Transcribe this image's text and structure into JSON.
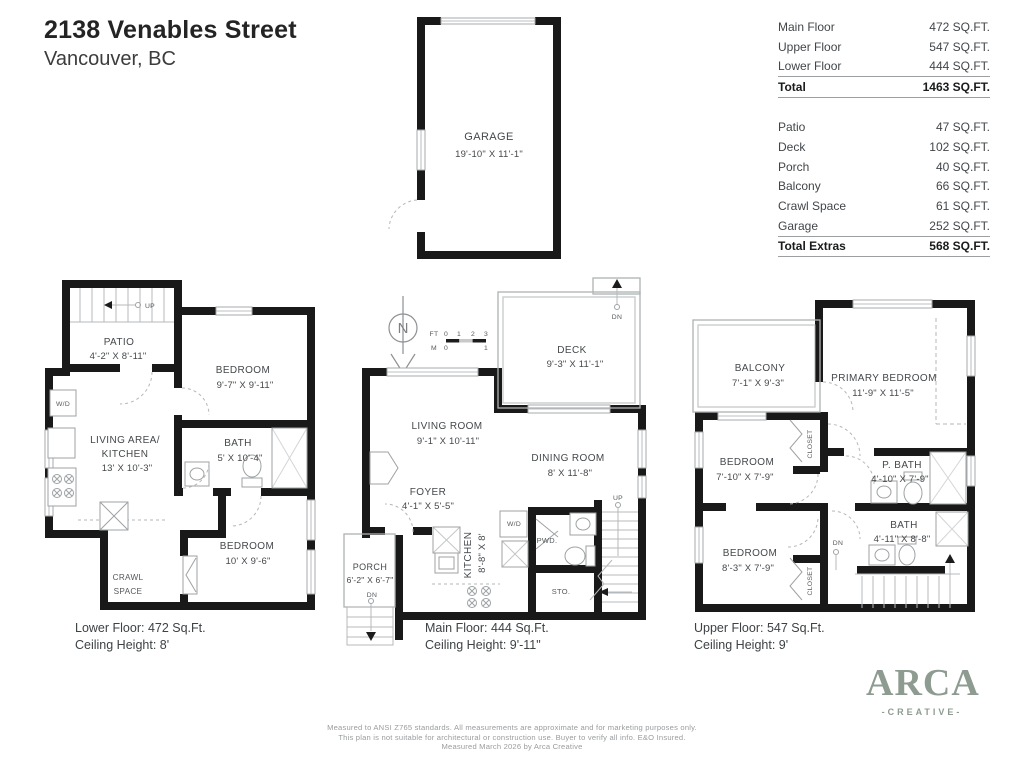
{
  "title": {
    "address": "2138 Venables Street",
    "city": "Vancouver, BC"
  },
  "area_table": {
    "floors": [
      {
        "label": "Main Floor",
        "value": "472 SQ.FT."
      },
      {
        "label": "Upper Floor",
        "value": "547 SQ.FT."
      },
      {
        "label": "Lower Floor",
        "value": "444 SQ.FT."
      }
    ],
    "total": {
      "label": "Total",
      "value": "1463 SQ.FT."
    },
    "extras": [
      {
        "label": "Patio",
        "value": "47 SQ.FT."
      },
      {
        "label": "Deck",
        "value": "102 SQ.FT."
      },
      {
        "label": "Porch",
        "value": "40 SQ.FT."
      },
      {
        "label": "Balcony",
        "value": "66 SQ.FT."
      },
      {
        "label": "Crawl Space",
        "value": "61 SQ.FT."
      },
      {
        "label": "Garage",
        "value": "252 SQ.FT."
      }
    ],
    "total_extras": {
      "label": "Total Extras",
      "value": "568 SQ.FT."
    }
  },
  "garage": {
    "label": "GARAGE",
    "dims": "19'-10\" X 11'-1\""
  },
  "compass": {
    "letter": "N"
  },
  "scale_bar": {
    "ft": "FT",
    "m": "M",
    "ft0": "0",
    "ft1": "1",
    "ft2": "2",
    "ft3": "3",
    "m0": "0",
    "m1": "1"
  },
  "lower_floor": {
    "patio": {
      "label": "PATIO",
      "dims": "4'-2\" X 8'-11\""
    },
    "bedroom_top": {
      "label": "BEDROOM",
      "dims": "9'-7\" X 9'-11\""
    },
    "living": {
      "label_line1": "LIVING AREA/",
      "label_line2": "KITCHEN",
      "dims": "13' X 10'-3\""
    },
    "bath": {
      "label": "BATH",
      "dims": "5' X 10'-4\""
    },
    "bedroom_bottom": {
      "label": "BEDROOM",
      "dims": "10' X 9'-6\""
    },
    "crawl_line1": "CRAWL",
    "crawl_line2": "SPACE",
    "wd": "W/D",
    "up": "UP",
    "caption_line1": "Lower Floor: 472 Sq.Ft.",
    "caption_line2": "Ceiling Height: 8'"
  },
  "main_floor": {
    "deck": {
      "label": "DECK",
      "dims": "9'-3\" X 11'-1\""
    },
    "living": {
      "label": "LIVING ROOM",
      "dims": "9'-1\" X 10'-11\""
    },
    "dining": {
      "label": "DINING ROOM",
      "dims": "8' X 11'-8\""
    },
    "foyer": {
      "label": "FOYER",
      "dims": "4'-1\" X 5'-5\""
    },
    "porch": {
      "label": "PORCH",
      "dims": "6'-2\" X 6'-7\""
    },
    "kitchen": {
      "label": "KITCHEN",
      "dims": "8'-8\" X 8'"
    },
    "wd": "W/D",
    "pwd": "PWD.",
    "sto": "STO.",
    "up": "UP",
    "dn_porch": "DN",
    "dn_deck": "DN",
    "caption_line1": "Main Floor: 444 Sq.Ft.",
    "caption_line2": "Ceiling Height: 9'-11\""
  },
  "upper_floor": {
    "balcony": {
      "label": "BALCONY",
      "dims": "7'-1\" X 9'-3\""
    },
    "primary": {
      "label": "PRIMARY BEDROOM",
      "dims": "11'-9\" X 11'-5\""
    },
    "bedroom_mid": {
      "label": "BEDROOM",
      "dims": "7'-10\" X 7'-9\""
    },
    "bedroom_bottom": {
      "label": "BEDROOM",
      "dims": "8'-3\" X 7'-9\""
    },
    "pbath": {
      "label": "P. BATH",
      "dims": "4'-10\" X 7'-9\""
    },
    "bath": {
      "label": "BATH",
      "dims": "4'-11\" X 8'-8\""
    },
    "closet_top": "CLOSET",
    "closet_bottom": "CLOSET",
    "dn": "DN",
    "caption_line1": "Upper Floor: 547 Sq.Ft.",
    "caption_line2": "Ceiling Height: 9'"
  },
  "footer": {
    "disclaimer_line1": "Measured to ANSI Z765 standards. All measurements are approximate and for marketing purposes only.",
    "disclaimer_line2": "This plan is not suitable for architectural or construction use. Buyer to verify all info. E&O Insured.",
    "disclaimer_line3": "Measured March 2026 by Arca Creative"
  },
  "logo": {
    "word": "ARCA",
    "tagline": "-CREATIVE-",
    "color": "#8d9b90"
  }
}
